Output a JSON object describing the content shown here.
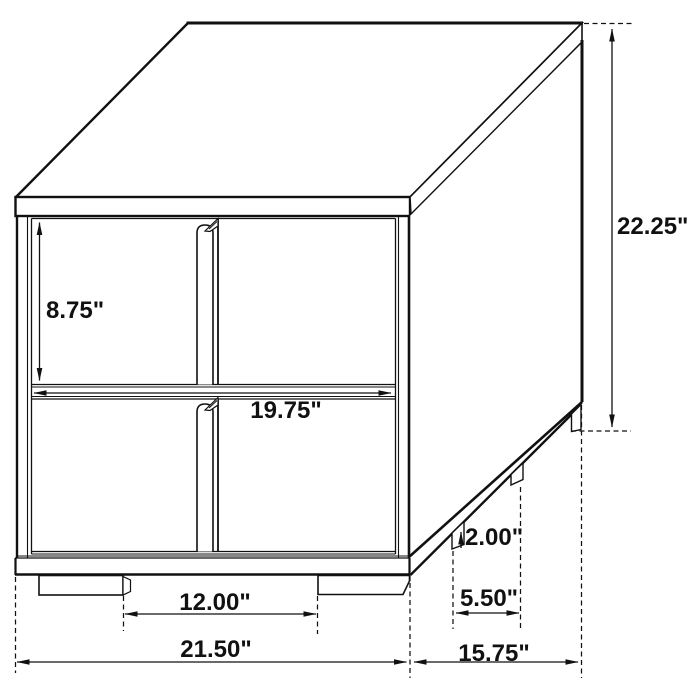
{
  "figure": {
    "type": "furniture-dimension-diagram",
    "subject": "Two-drawer nightstand, isometric technical line drawing with dimension callouts",
    "unit": "inches",
    "background_color": "#ffffff",
    "line_color": "#111111",
    "text_color": "#111111"
  },
  "dimensions": {
    "drawer_front_height": {
      "label": "8.75\"",
      "measures": "front drawer opening height"
    },
    "overall_height": {
      "label": "22.25\"",
      "measures": "overall height"
    },
    "drawer_width": {
      "label": "19.75\"",
      "measures": "drawer front width"
    },
    "leg_height": {
      "label": "2.00\"",
      "measures": "foot height"
    },
    "side_foot_spacing": {
      "label": "5.50\"",
      "measures": "spacing between side feet"
    },
    "front_foot_spacing": {
      "label": "12.00\"",
      "measures": "spacing between front feet"
    },
    "overall_width": {
      "label": "21.50\"",
      "measures": "overall width"
    },
    "overall_depth": {
      "label": "15.75\"",
      "measures": "overall depth"
    }
  }
}
